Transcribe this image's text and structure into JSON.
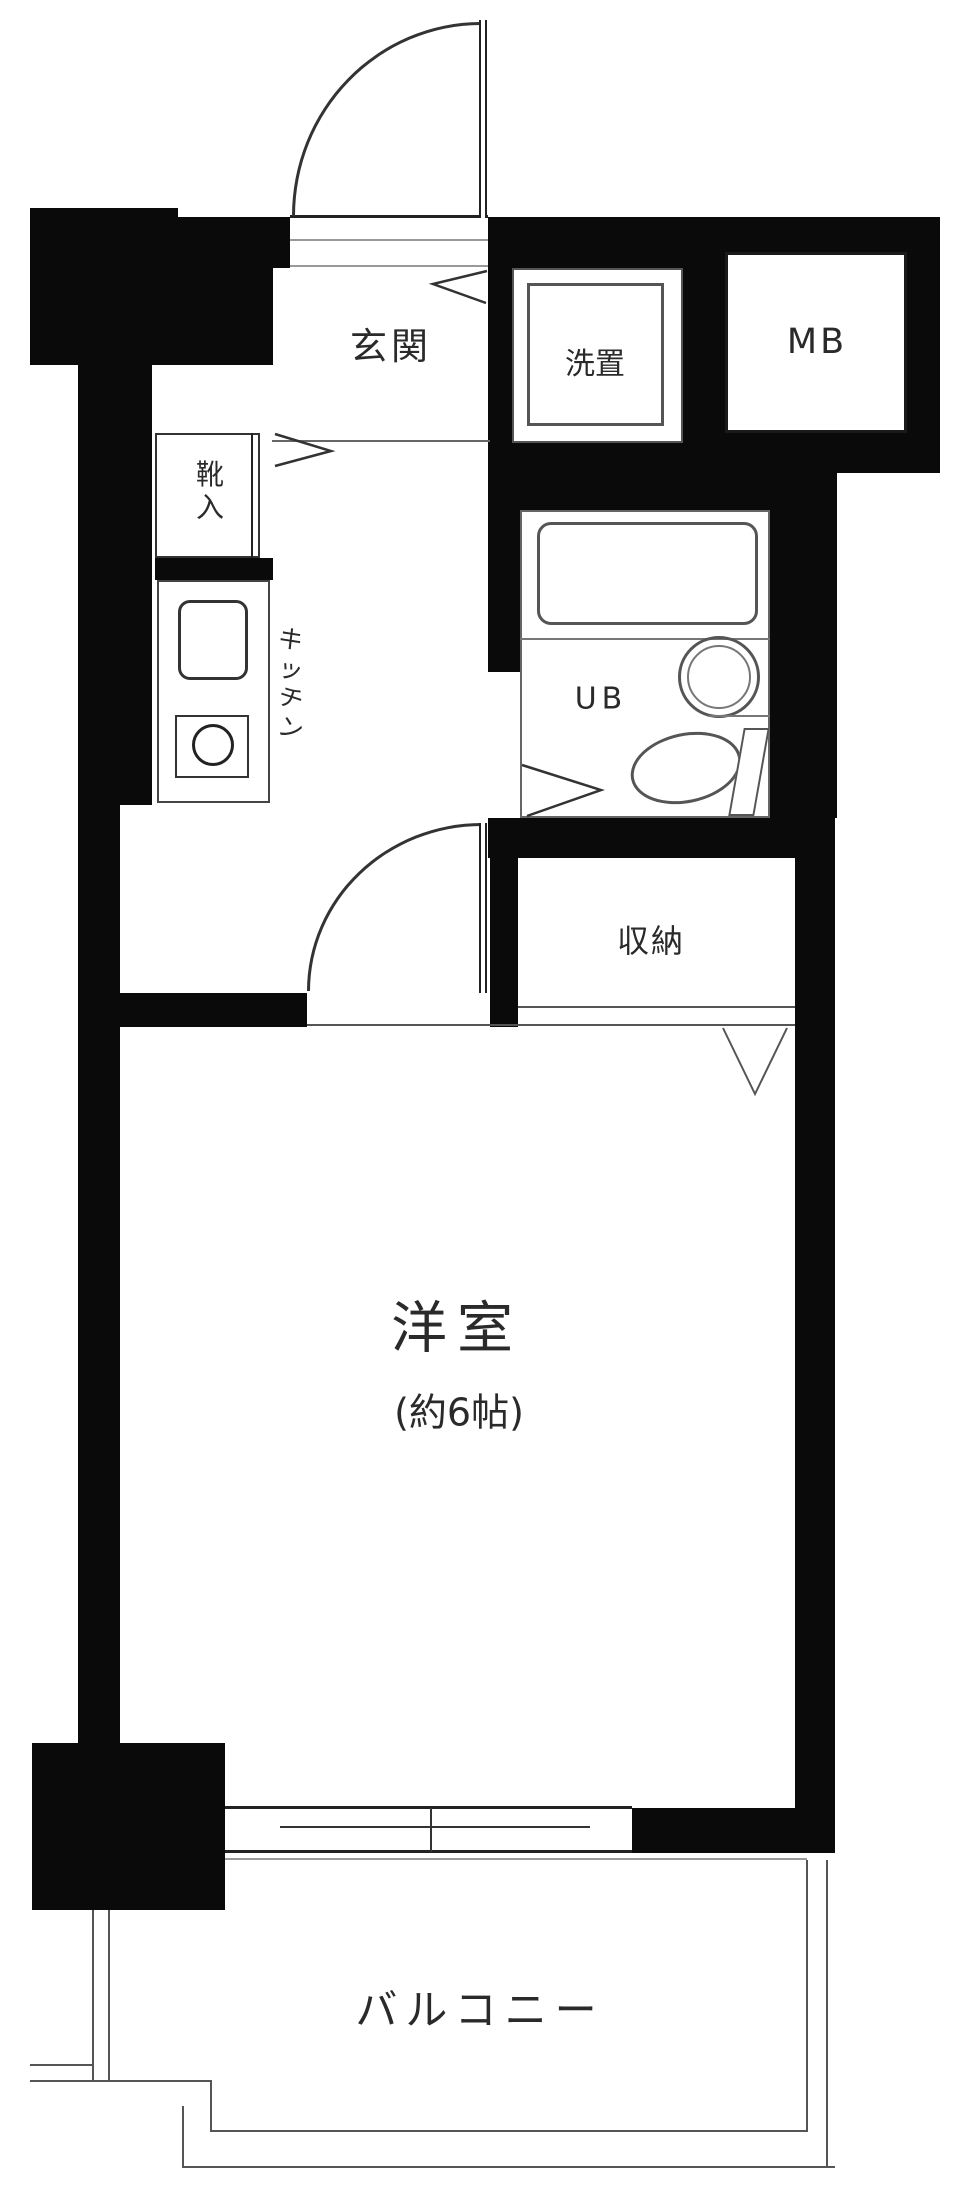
{
  "floorplan": {
    "title": "1K apartment floor plan",
    "rooms": {
      "genkan": {
        "label": "玄関"
      },
      "laundry": {
        "label": "洗置"
      },
      "meter_box": {
        "label": "MB"
      },
      "shoe_cabinet": {
        "label": "靴入",
        "chars": [
          "靴",
          "入"
        ]
      },
      "kitchen": {
        "label": "キッチン",
        "chars": [
          "キ",
          "ッ",
          "チ",
          "ン"
        ]
      },
      "unit_bath": {
        "label": "UB"
      },
      "storage": {
        "label": "収納"
      },
      "western_room": {
        "label": "洋室",
        "size_note": "(約6帖)"
      },
      "balcony": {
        "label": "バルコニー"
      }
    },
    "colors": {
      "wall": "#0a0a0a",
      "thin_line": "#555555",
      "text": "#2a2a2a",
      "background": "#ffffff"
    }
  }
}
